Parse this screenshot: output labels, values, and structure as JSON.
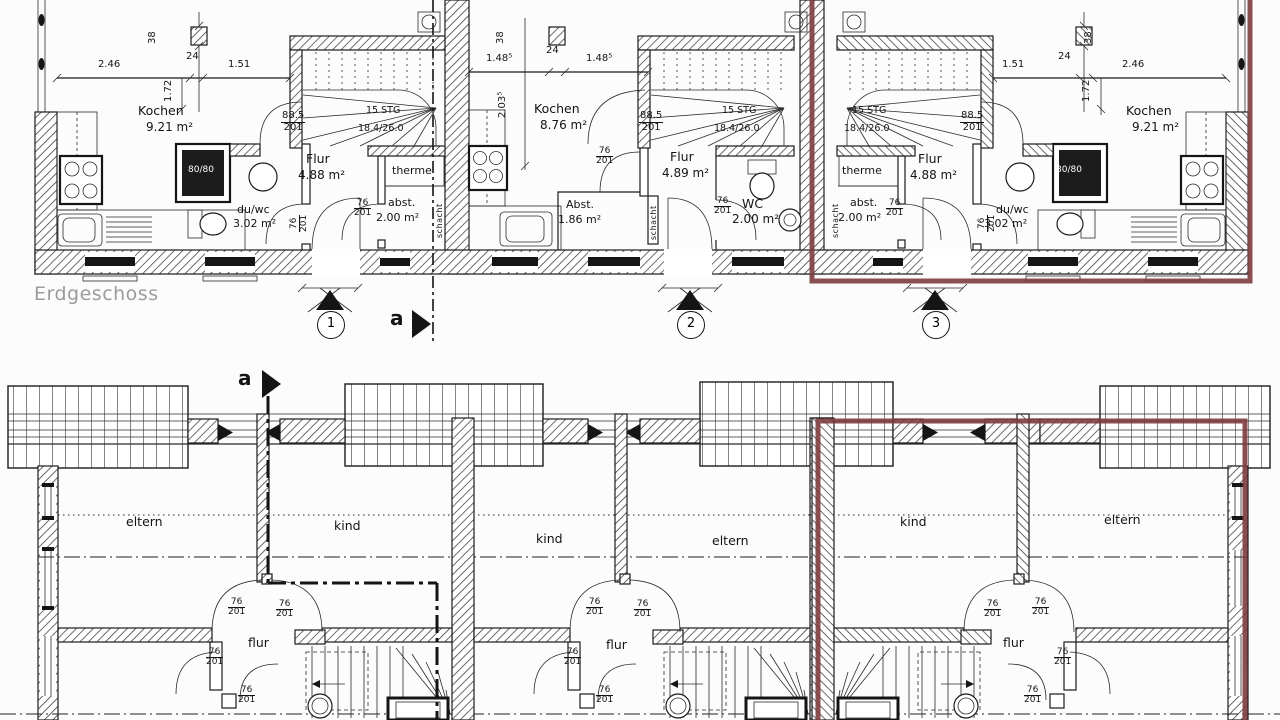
{
  "title": "Erdgeschoss",
  "colors": {
    "highlight": "#7d3c3e",
    "title": "#9c9c9c"
  },
  "section": {
    "letter": "a"
  },
  "markers": {
    "m1": "1",
    "m2": "2",
    "m3": "3"
  },
  "rooms": {
    "kochen": "Kochen",
    "flur": "Flur",
    "wc": "WC",
    "duwc": "du/wc",
    "abst_lc": "abst.",
    "abst_uc": "Abst.",
    "therme": "therme",
    "schacht": "schacht",
    "eltern": "eltern",
    "kind": "kind",
    "flur_og": "flur"
  },
  "areas": {
    "kochen_side": "9.21 m²",
    "kochen_mid": "8.76 m²",
    "flur_side": "4.88 m²",
    "flur_mid": "4.89 m²",
    "duwc": "3.02 m²",
    "abst_side": "2.00 m²",
    "abst_mid": "1.86 m²",
    "wc": "2.00 m²"
  },
  "stairs": {
    "count": "15 STG",
    "rise_run": "18.4/26.0"
  },
  "openings": {
    "door_w": "76",
    "door_h": "201",
    "win_w": "88.5",
    "win_h": "201",
    "shower": "80/80"
  },
  "dims": {
    "d246": "2.46",
    "d24": "24",
    "d151": "1.51",
    "d172": "1.72",
    "d38": "38",
    "d1485": "1.48⁵",
    "d2035": "2.03⁵"
  }
}
